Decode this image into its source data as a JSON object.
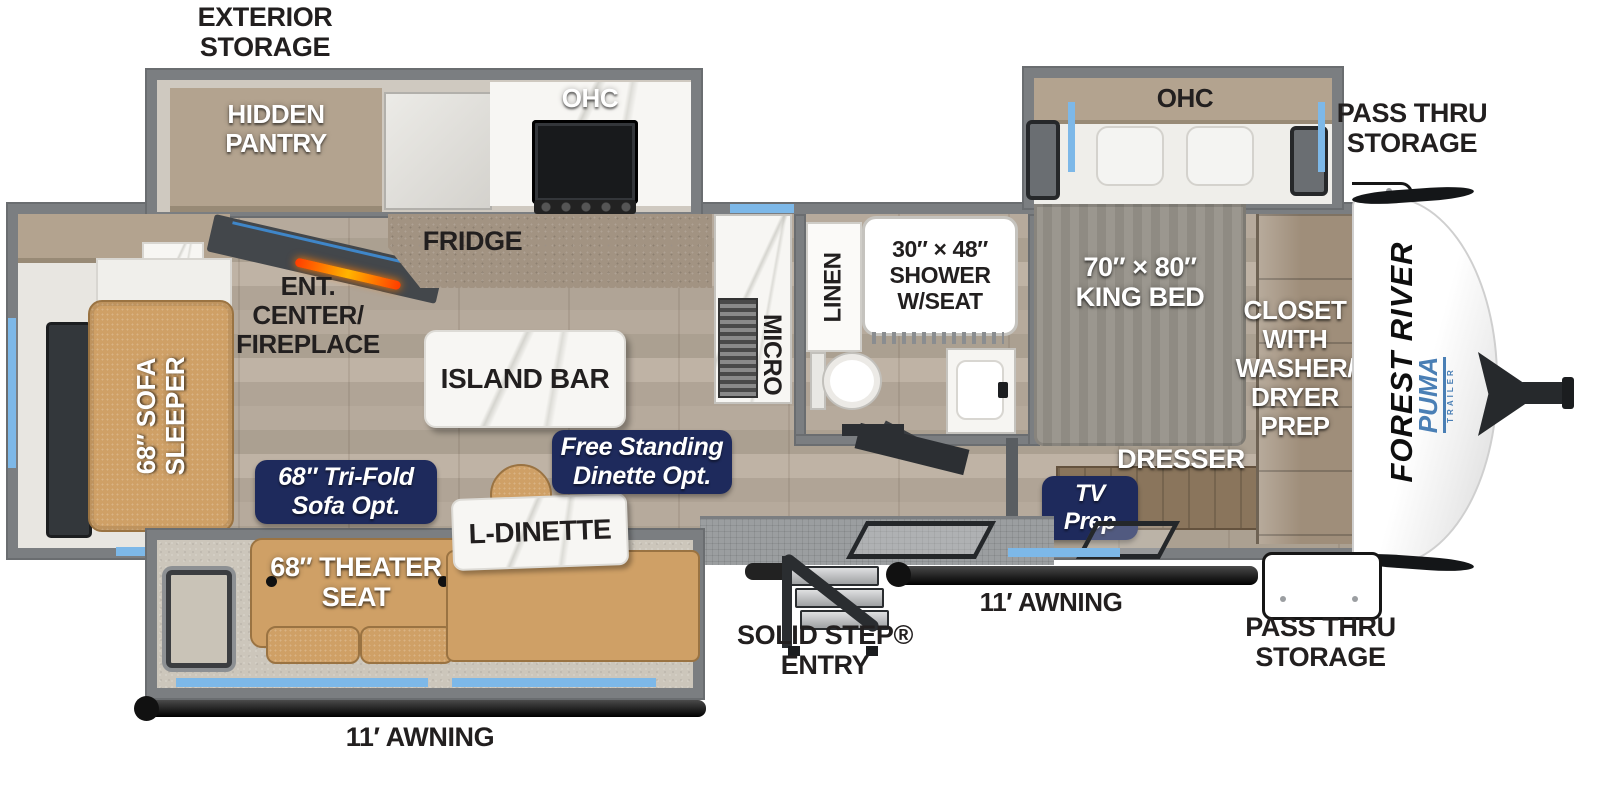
{
  "title": "Forest River Puma travel trailer floor plan",
  "colors": {
    "wall_gray": "#7b7e81",
    "badge_navy": "#1e2a5c",
    "accent_blue": "#7db8e8",
    "puma_blue": "#4a7fb5",
    "label_black": "#221f1f",
    "sofa_tan": "#cfa066",
    "fireplace_orange": "#ff7a00"
  },
  "ext": {
    "exterior_storage": {
      "l1": "EXTERIOR",
      "l2": "STORAGE"
    },
    "pass_thru_top": {
      "l1": "PASS THRU",
      "l2": "STORAGE"
    },
    "pass_thru_bottom": {
      "l1": "PASS THRU",
      "l2": "STORAGE"
    },
    "awning_left": "11′ AWNING",
    "awning_right": "11′ AWNING",
    "solid_step": {
      "l1": "SOLID STEP®",
      "l2": "ENTRY"
    },
    "brand": "FOREST RIVER",
    "logo": "PUMA",
    "logo_sub": "TRAILER"
  },
  "kitchen": {
    "hidden_pantry": {
      "l1": "HIDDEN",
      "l2": "PANTRY"
    },
    "ohc": "OHC",
    "fridge": "FRIDGE",
    "island_bar": "ISLAND BAR",
    "ent": {
      "l1": "ENT.",
      "l2": "CENTER/",
      "l3": "FIREPLACE"
    },
    "micro": "MICRO"
  },
  "living": {
    "sofa_sleeper": {
      "l1": "68″ SOFA",
      "l2": "SLEEPER"
    },
    "theater_seat": {
      "l1": "68″ THEATER",
      "l2": "SEAT"
    },
    "l_dinette": "L-DINETTE",
    "tri_fold": {
      "l1": "68″ Tri-Fold",
      "l2": "Sofa Opt."
    },
    "free_standing": {
      "l1": "Free Standing",
      "l2": "Dinette Opt."
    }
  },
  "bath": {
    "linen": "LINEN",
    "shower": {
      "l1": "30″ × 48″",
      "l2": "SHOWER",
      "l3": "W/SEAT"
    }
  },
  "bedroom": {
    "ohc": "OHC",
    "king_bed": {
      "l1": "70″ × 80″",
      "l2": "KING BED"
    },
    "closet": {
      "l1": "CLOSET",
      "l2": "WITH",
      "l3": "WASHER/",
      "l4": "DRYER",
      "l5": "PREP"
    },
    "dresser": "DRESSER",
    "tv_prep": {
      "l1": "TV",
      "l2": "Prep"
    }
  }
}
